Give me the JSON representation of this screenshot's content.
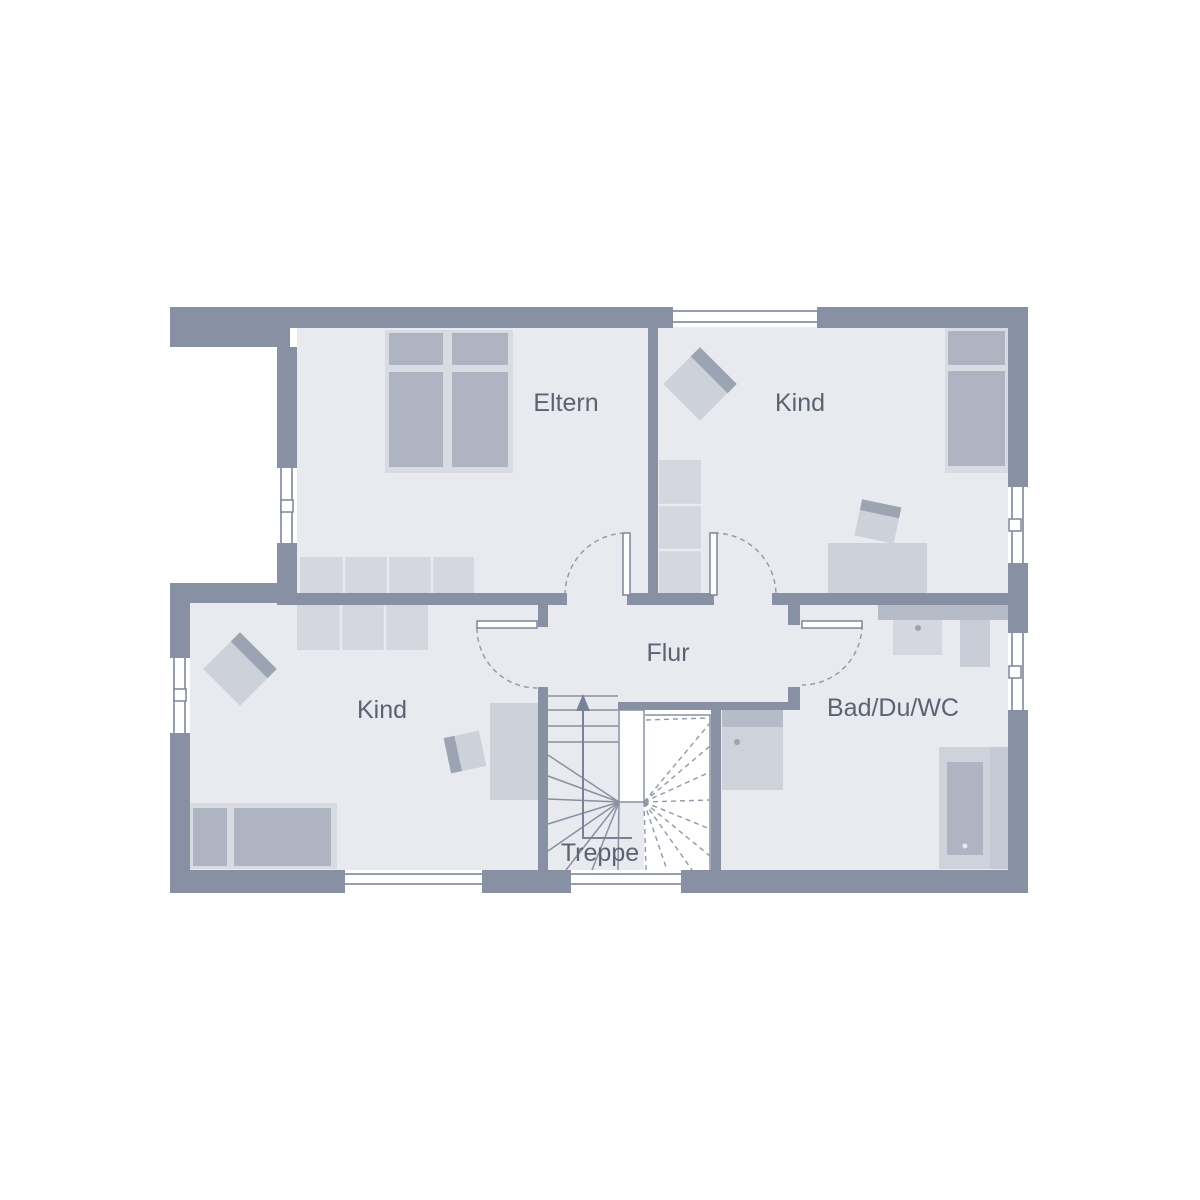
{
  "plan": {
    "type": "floor-plan",
    "language": "de",
    "rooms": [
      {
        "id": "eltern",
        "label": "Eltern",
        "furniture": [
          "double-bed",
          "wardrobe-row"
        ]
      },
      {
        "id": "kind-top",
        "label": "Kind",
        "furniture": [
          "single-bed",
          "shelf",
          "desk",
          "chair",
          "armchair"
        ]
      },
      {
        "id": "kind-bottom",
        "label": "Kind",
        "furniture": [
          "single-bed",
          "wardrobe-row",
          "desk",
          "chair",
          "armchair"
        ]
      },
      {
        "id": "flur",
        "label": "Flur",
        "furniture": []
      },
      {
        "id": "bad",
        "label": "Bad/Du/WC",
        "furniture": [
          "shower",
          "washbasin-counter",
          "wc",
          "bathtub"
        ]
      },
      {
        "id": "treppe",
        "label": "Treppe",
        "furniture": [
          "winder-staircase",
          "up-arrow"
        ]
      }
    ],
    "door_count": 4,
    "window_count": 7,
    "colors": {
      "wall": "#8891A3",
      "floor": "#E8EAF0",
      "furniture_light": "#D8DBE2",
      "furniture_medium": "#AEB4C2",
      "furniture_accent": "#9CA3B2",
      "lines": "#8891A3",
      "label_text": "#5A6372",
      "background": "#FFFFFF"
    }
  }
}
